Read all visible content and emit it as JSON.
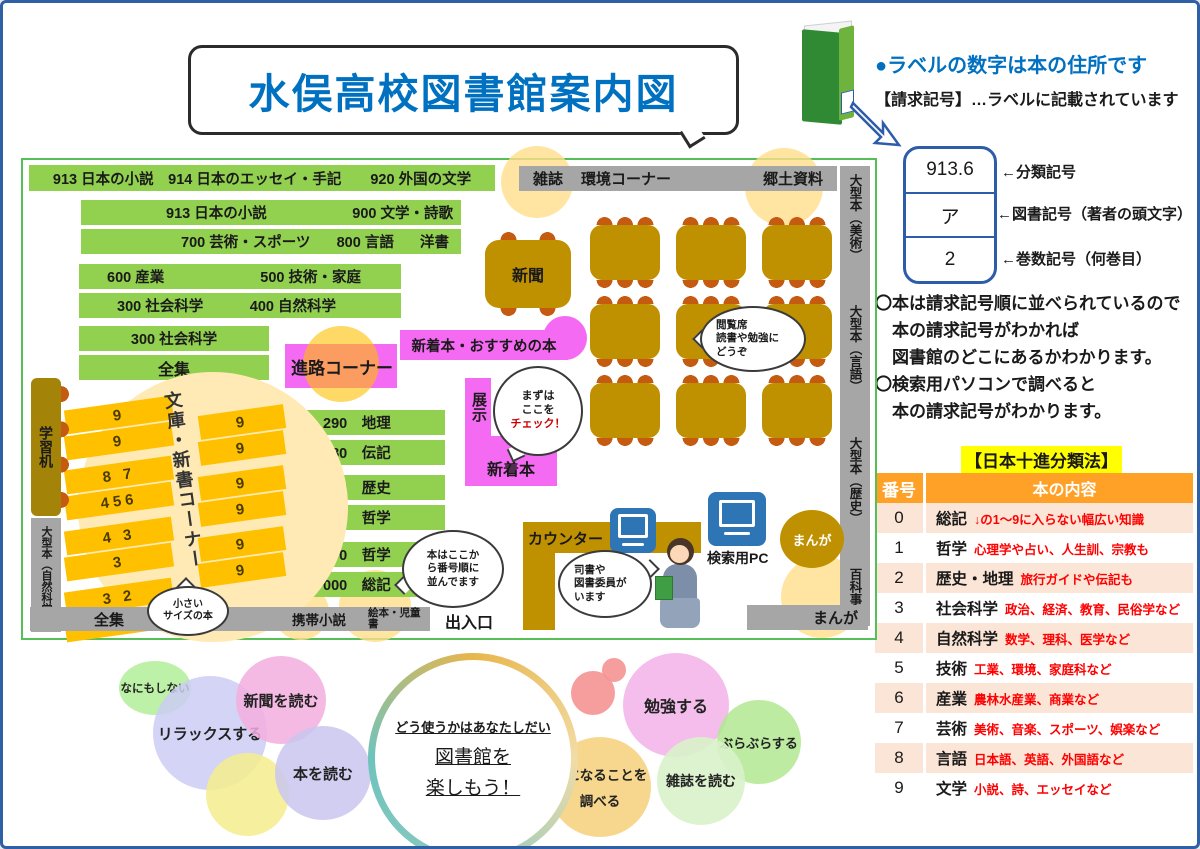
{
  "palette": {
    "title_blue": "#0070c0",
    "shelf_green": "#92d050",
    "zone_pink": "#f56af2",
    "wood_gold": "#bf9000",
    "chair_orange": "#c55a11",
    "bunko_gold": "#ffc000",
    "wall_gray": "#a6a6a6",
    "ndc_header_orange": "#ffa126",
    "ndc_row_peach": "#fbe5d6",
    "accent_red": "#ff0000",
    "label_border_blue": "#2d5ca8",
    "map_border_green": "#57bf57",
    "highlight_yellow": "#ffff00"
  },
  "title": "水俣高校図書館案内図",
  "call_label": {
    "headline": "●ラベルの数字は本の住所です",
    "subline": "【請求記号】…ラベルに記載されています",
    "box": {
      "class_mark": "913.6",
      "author_mark": "ア",
      "volume_mark": "2"
    },
    "arrow_labels": [
      "←分類記号",
      "←図書記号（著者の頭文字）",
      "←巻数記号（何巻目）"
    ],
    "notes": [
      "〇本は請求記号順に並べられているので",
      "本の請求記号がわかれば",
      "図書館のどこにあるかわかります。",
      "〇検索用パソコンで調べると",
      "本の請求記号がわかります。"
    ]
  },
  "ndc": {
    "title": "【日本十進分類法】",
    "col_num": "番号",
    "col_content": "本の内容",
    "rows": [
      {
        "num": "0",
        "cat": "総記",
        "desc": "↓の1～9に入らない幅広い知識"
      },
      {
        "num": "1",
        "cat": "哲学",
        "desc": "心理学や占い、人生訓、宗教も"
      },
      {
        "num": "2",
        "cat": "歴史・地理",
        "desc": "旅行ガイドや伝記も"
      },
      {
        "num": "3",
        "cat": "社会科学",
        "desc": "政治、経済、教育、民俗学など"
      },
      {
        "num": "4",
        "cat": "自然科学",
        "desc": "数学、理科、医学など"
      },
      {
        "num": "5",
        "cat": "技術",
        "desc": "工業、環境、家庭科など"
      },
      {
        "num": "6",
        "cat": "産業",
        "desc": "農林水産業、商業など"
      },
      {
        "num": "7",
        "cat": "芸術",
        "desc": "美術、音楽、スポーツ、娯楽など"
      },
      {
        "num": "8",
        "cat": "言語",
        "desc": "日本語、英語、外国語など"
      },
      {
        "num": "9",
        "cat": "文学",
        "desc": "小説、詩、エッセイなど"
      }
    ]
  },
  "map": {
    "top_shelf": "913 日本の小説　914 日本のエッセイ・手記　　920 外国の文学",
    "top_wall": {
      "a": "雑誌",
      "b": "環境コーナー",
      "c": "郷土資料"
    },
    "right_wall": [
      "大型本（美術）",
      "大型本（言語）",
      "大型本（歴史）",
      "百科事典"
    ],
    "left_wall": {
      "desk": "学習机",
      "large_books": "大型本（自然科学）"
    },
    "bottom_wall": {
      "zenshu": "全集",
      "keitai": "携帯小説",
      "ehon": "絵本・児童書",
      "exit": "出入口",
      "manga": "まんが"
    },
    "shelves_nw": [
      {
        "a": "913 日本の小説",
        "b": "900 文学・詩歌"
      },
      {
        "a": "700 芸術・スポーツ",
        "b": "800 言語",
        "c": "洋書"
      },
      {
        "a": "600 産業",
        "b": "500 技術・家庭"
      },
      {
        "a": "300 社会科学",
        "b": "400 自然科学"
      },
      {
        "a": "300 社会科学"
      },
      {
        "a": "全集"
      }
    ],
    "shelves_mid": [
      "290　地理",
      "280　伝記",
      "200　歴史",
      "150　哲学",
      "100　哲学",
      "000　総記"
    ],
    "zones": {
      "shinro": "進路コーナー",
      "new_books_bar": "新着本・おすすめの本",
      "tenji": "展示",
      "shinchaku": "新着本",
      "shimbun": "新聞",
      "counter": "カウンター",
      "search_pc": "検索用PC",
      "manga_ellipse": "まんが"
    },
    "bunko": {
      "title": "文庫・新書コーナー",
      "left_numbers": [
        "9",
        "9",
        "8 7",
        "456",
        "4 3",
        "3",
        "3 2",
        "0 1"
      ],
      "right_numbers": [
        "9",
        "9",
        "9",
        "9",
        "9",
        "9"
      ],
      "note": [
        "小さい",
        "サイズの本"
      ]
    },
    "bubbles": {
      "check": [
        "まずは",
        "ここを",
        "チェック！"
      ],
      "etsuran": [
        "閲覧席",
        "読書や勉強に",
        "どうぞ"
      ],
      "order": [
        "本はここか",
        "ら番号順に",
        "並んでます"
      ],
      "shisho": [
        "司書や",
        "図書委員が",
        "います"
      ]
    }
  },
  "activity": {
    "center": [
      "どう使うかはあなたしだい",
      "図書館を",
      "楽しもう！"
    ],
    "nanimo": "なにもしない",
    "relax": "リラックスする",
    "news": "新聞を読む",
    "book": "本を読む",
    "study": "勉強する",
    "burabura": "ぶらぶらする",
    "kininaru": [
      "気になることを",
      "調べる"
    ],
    "zasshi": "雑誌を読む"
  }
}
